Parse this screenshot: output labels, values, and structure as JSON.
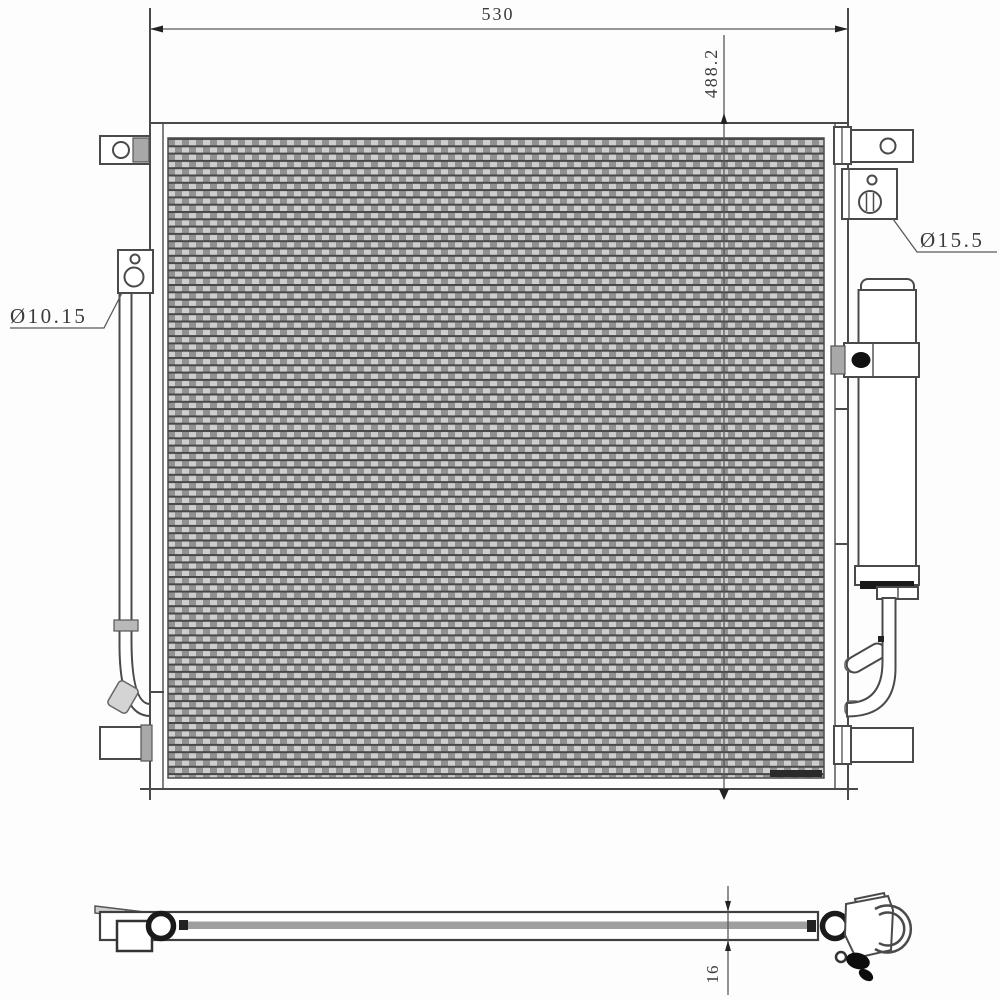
{
  "drawing": {
    "dimensions": {
      "overall_width": "530",
      "overall_height": "488.2",
      "core_thickness": "16"
    },
    "port_labels": {
      "left_port": "Ø10.15",
      "right_port": "Ø15.5"
    },
    "colors": {
      "line": "#4a4a4a",
      "background": "#fdfdfd",
      "fin_dark": "#474747",
      "fin_mid": "#919191",
      "fin_light": "#cecece",
      "bolt": "#111111"
    }
  }
}
